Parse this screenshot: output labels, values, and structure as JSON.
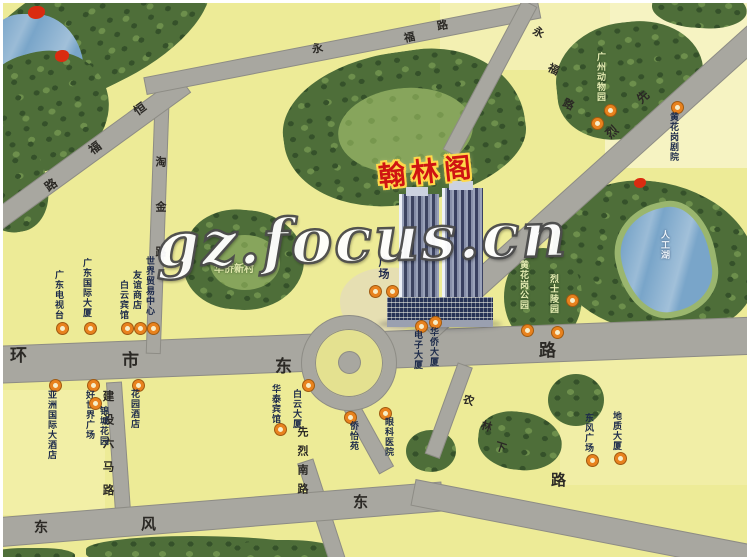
{
  "watermark": "gz.focus.cn",
  "title": {
    "text": "翰林阁",
    "color": "#cf1412",
    "outline": "#ffd84a"
  },
  "labels": {
    "plaza": "广场",
    "village": "华侨新村",
    "zoo": "广州动物园",
    "lake": "人工湖"
  },
  "road_names": {
    "jianshe": "建设六马路",
    "xianlie_south": "先烈南路",
    "taojin": "淘金路"
  },
  "road_chars": {
    "huanshi": [
      "环",
      "市",
      "东",
      "路"
    ],
    "dongfeng": [
      "东",
      "风",
      "东",
      "路"
    ],
    "hengfu": [
      "恒",
      "福",
      "路"
    ],
    "yongfu1": [
      "永",
      "福",
      "路"
    ],
    "yongfu2": [
      "永",
      "福",
      "路"
    ],
    "xianlie_mid": [
      "先",
      "烈"
    ],
    "nonglin": [
      "农",
      "林",
      "下"
    ]
  },
  "markers": [
    {
      "label": "广东电视台"
    },
    {
      "label": "广东国际大厦"
    },
    {
      "label": "白云宾馆"
    },
    {
      "label": "友谊商店"
    },
    {
      "label": "世界贸易中心"
    },
    {
      "label": "电子大厦"
    },
    {
      "label": "华侨大厦"
    },
    {
      "label": "亚洲国际大酒店"
    },
    {
      "label": "好世界广场"
    },
    {
      "label": "锦城花园"
    },
    {
      "label": "花园酒店"
    },
    {
      "label": "华泰宾馆"
    },
    {
      "label": "白云大厦"
    },
    {
      "label": "侨怡苑"
    },
    {
      "label": "眼科医院"
    },
    {
      "label": "黄花岗公园"
    },
    {
      "label": "烈士陵园"
    },
    {
      "label": "东风广场"
    },
    {
      "label": "地质大厦"
    },
    {
      "label": "黄花岗剧院"
    }
  ],
  "colors": {
    "land": "#edeb97",
    "road": "#a8a7a0",
    "park": "#4e6e39",
    "water": "#79a5c9",
    "marker_ring": "#e8821e",
    "title_red": "#cf1412"
  }
}
